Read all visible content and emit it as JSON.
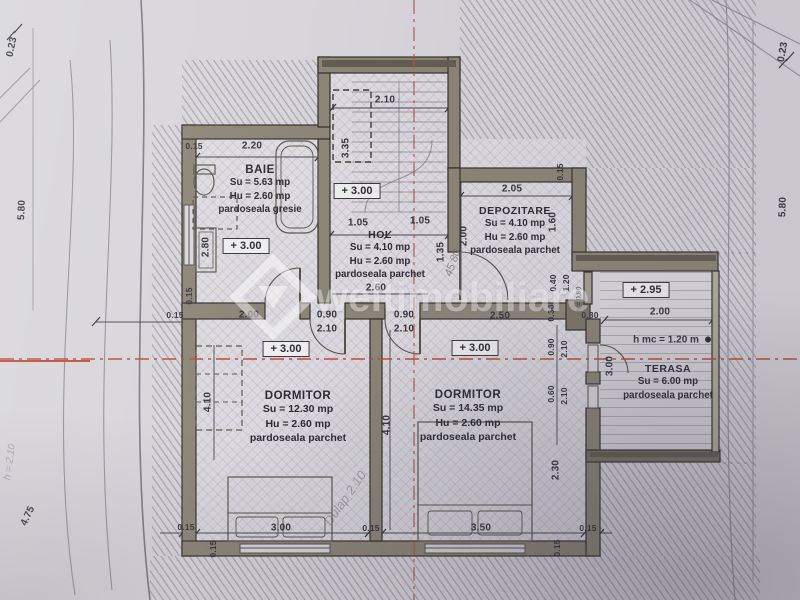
{
  "watermark": {
    "text": "weltimobiliare"
  },
  "rooms": {
    "baie": {
      "name": "BAIE",
      "su": "Su = 5.63 mp",
      "hu": "Hu = 2.60 mp",
      "floor": "pardoseala gresie"
    },
    "hol": {
      "name": "HOL",
      "su": "Su = 4.10 mp",
      "hu": "Hu = 2.60 mp",
      "floor": "pardoseala parchet"
    },
    "depozitare": {
      "name": "DEPOZITARE",
      "su": "Su = 4.10 mp",
      "hu": "Hu = 2.60 mp",
      "floor": "pardoseala parchet"
    },
    "dormitor1": {
      "name": "DORMITOR",
      "su": "Su = 12.30 mp",
      "hu": "Hu = 2.60 mp",
      "floor": "pardoseala parchet"
    },
    "dormitor2": {
      "name": "DORMITOR",
      "su": "Su = 14.35 mp",
      "hu": "Hu = 2.60 mp",
      "floor": "pardoseala parchet"
    },
    "terasa": {
      "name": "TERASA",
      "su": "Su = 6.00 mp",
      "floor": "pardoseala parchet",
      "note": "h mc = 1.20 m"
    }
  },
  "levels": {
    "stair": "+ 3.00",
    "baie": "+ 3.00",
    "dormitor1": "+ 3.00",
    "dormitor2": "+ 3.00",
    "terasa": "+ 2.95"
  },
  "dims": {
    "m023l": "0.23",
    "m580l": "5.80",
    "m475": "4.75",
    "m023r": "0.23",
    "m580r": "5.80",
    "stair_w": "2.10",
    "stair_h": "3.35",
    "baie_t015": "0.15",
    "baie_w": "2.20",
    "baie_h": "2.80",
    "baie_b015": "0.15",
    "hol_a": "1.05",
    "hol_b": "1.05",
    "hol_w": "2.60",
    "hol_d": "1.35",
    "mid_v": "2.00",
    "dep_w": "2.05",
    "dep_015": "0.15",
    "dep_h": "1.60",
    "dep_040": "0.40",
    "dep_120": "1.20",
    "dep_h090": "h = 0.90",
    "band_015": "0.15",
    "band_200": "2.00",
    "door1_w": "0.90",
    "door1_h": "2.10",
    "door2_w": "0.90",
    "door2_h": "2.10",
    "band_250": "2.50",
    "band_030a": "0.30",
    "band_030b": "0.30",
    "r_090": "0.90",
    "r_210a": "2.10",
    "r_060": "0.60",
    "r_210b": "2.10",
    "r_230": "2.30",
    "ter_300": "3.00",
    "ter_200": "2.00",
    "d1_410l": "4.10",
    "d1_410r": "4.10",
    "bot_015a": "0.15",
    "bot_300": "3.00",
    "bot_015b": "0.15",
    "bot_350": "3.50",
    "bot_015c": "0.15",
    "bot_015d": "0.15",
    "bot_015e": "0.15"
  },
  "notes": {
    "pencil_hol": "45 80",
    "pencil_dorm": "Dulap 2.10",
    "pencil_margin": "h = 2.10"
  }
}
